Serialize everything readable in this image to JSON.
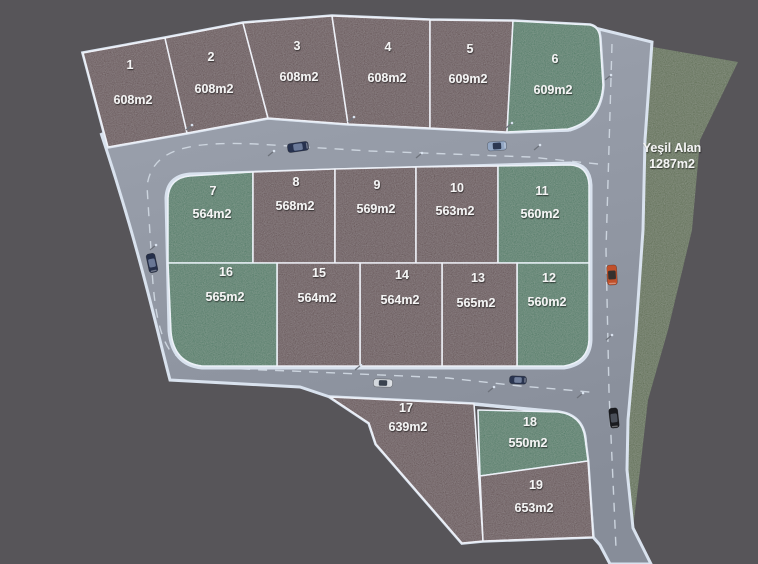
{
  "green_area": {
    "label": "Yeşil Alan",
    "area": "1287m2"
  },
  "plots": [
    {
      "number": "1",
      "area": "608m2",
      "type": "parcel"
    },
    {
      "number": "2",
      "area": "608m2",
      "type": "parcel"
    },
    {
      "number": "3",
      "area": "608m2",
      "type": "parcel"
    },
    {
      "number": "4",
      "area": "608m2",
      "type": "parcel"
    },
    {
      "number": "5",
      "area": "609m2",
      "type": "parcel"
    },
    {
      "number": "6",
      "area": "609m2",
      "type": "green"
    },
    {
      "number": "7",
      "area": "564m2",
      "type": "green"
    },
    {
      "number": "8",
      "area": "568m2",
      "type": "parcel"
    },
    {
      "number": "9",
      "area": "569m2",
      "type": "parcel"
    },
    {
      "number": "10",
      "area": "563m2",
      "type": "parcel"
    },
    {
      "number": "11",
      "area": "560m2",
      "type": "green"
    },
    {
      "number": "12",
      "area": "560m2",
      "type": "green"
    },
    {
      "number": "13",
      "area": "565m2",
      "type": "parcel"
    },
    {
      "number": "14",
      "area": "564m2",
      "type": "parcel"
    },
    {
      "number": "15",
      "area": "564m2",
      "type": "parcel"
    },
    {
      "number": "16",
      "area": "565m2",
      "type": "green"
    },
    {
      "number": "17",
      "area": "639m2",
      "type": "parcel"
    },
    {
      "number": "18",
      "area": "550m2",
      "type": "green"
    },
    {
      "number": "19",
      "area": "653m2",
      "type": "parcel"
    }
  ],
  "colors": {
    "background": "#575559",
    "parcel": "#47242c",
    "green_plot": "#19684a",
    "green_area": "#3a5524",
    "road": "#9da3af",
    "road_shadow": "#878d99",
    "curb": "#d9e2ee",
    "dash": "#ccd4de",
    "plot_border": "#e9eef6",
    "label": "#f4f4f4",
    "pole": "#6e737c"
  },
  "cars": [
    {
      "name": "sedan-dark-blue",
      "body": "#27324f",
      "glass": "#6b7a99"
    },
    {
      "name": "sedan-light-blue",
      "body": "#93a7c4",
      "glass": "#2c3852"
    },
    {
      "name": "sedan-dark-blue-2",
      "body": "#252f4a",
      "glass": "#697795"
    },
    {
      "name": "sedan-white",
      "body": "#d3d8de",
      "glass": "#39424f"
    },
    {
      "name": "sedan-navy",
      "body": "#2a3550",
      "glass": "#707e9b"
    },
    {
      "name": "sedan-orange",
      "body": "#c1502a",
      "glass": "#35302e"
    },
    {
      "name": "sedan-black",
      "body": "#1a1b1f",
      "glass": "#4a4f59"
    }
  ]
}
